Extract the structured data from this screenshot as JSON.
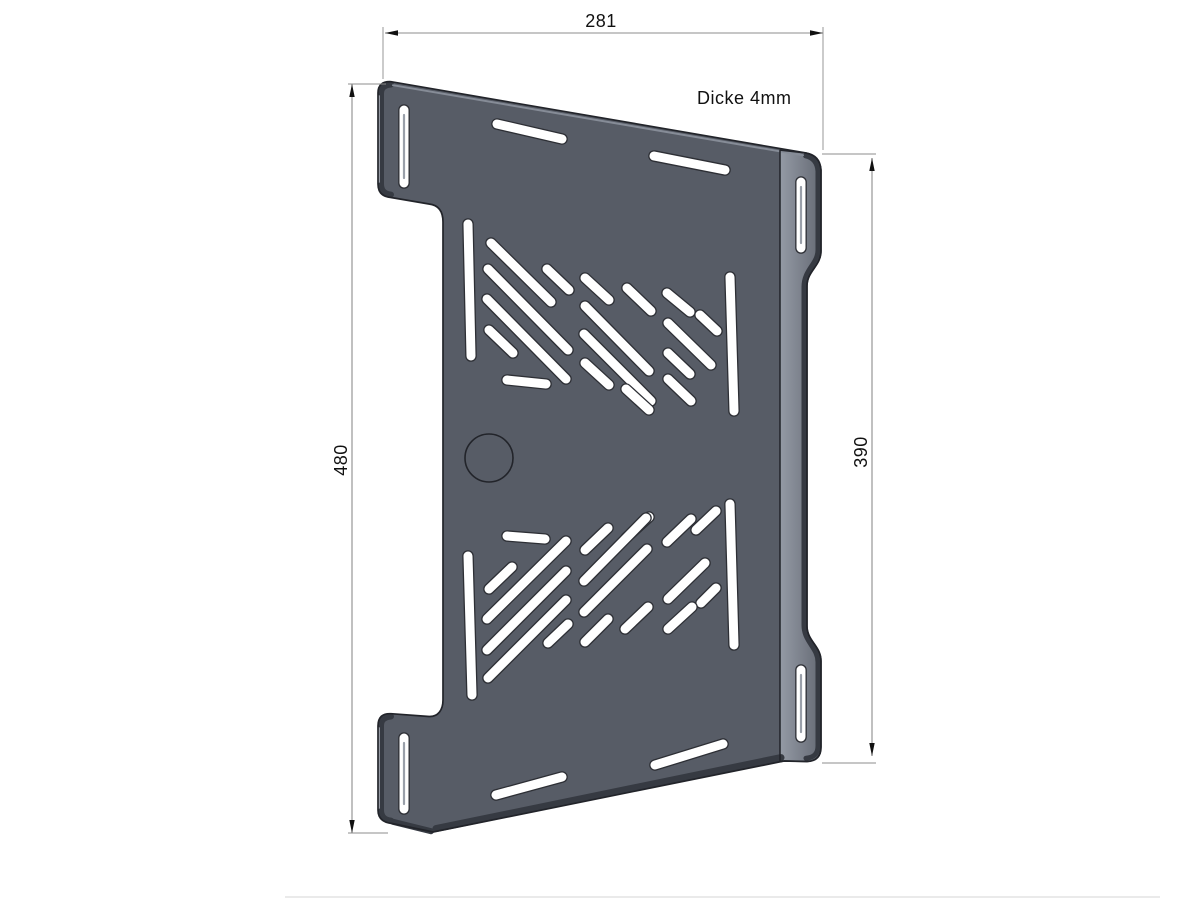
{
  "drawing": {
    "canvas": {
      "width": 1200,
      "height": 900,
      "background": "#ffffff"
    },
    "labels": {
      "top_width": "281",
      "left_height": "480",
      "right_height": "390",
      "thickness_note": "Dicke 4mm"
    },
    "colors": {
      "face": "#575c66",
      "face_light": "#949aa5",
      "face_shadow": "#656a74",
      "edge_dark": "#363a42",
      "edge_mid": "#868c97",
      "edge_light": "#b3b8c2",
      "outline": "#22242a",
      "slot_fill": "#ffffff",
      "slot_outline": "#2d2f35",
      "slot_inner": "#9aa0aa",
      "dim_line": "#8c8c8c",
      "text": "#111111",
      "rule": "#dddddd"
    },
    "paths": {
      "silhouette": "M 378 93 Q 378 81 391 81.7 L 806 153 Q 820 155.5 821 170 L 821 251 C 821 266 807 271 807 286 L 807 626 C 807 641 821 646 821 661 L 821 747 Q 821 761 807 761.5 L 784 761 L 433 832 L 392 823.5 Q 378 822 378 810 L 378 726 Q 378 713 391 713.7 L 429 716.5 C 438 717 443 710 443 700 L 443 222 C 443 211 438 205 429 204 L 391 197.5 Q 378 196.5 378 184 Z",
      "right_strip": "M 780 150.2 L 806 153 Q 820 155.5 821 170 L 821 251 C 821 266 807 271 807 286 L 807 626 C 807 641 821 646 821 661 L 821 747 Q 821 761 807 761.5 L 784 761 L 780 761.8 Z",
      "band_right": "M 805.5 155.8 Q 817 158.2 818 171 L 818 250 C 818 264 804 269.5 804 287 L 804 625 C 804 642 818 647.5 818 662 L 818 746 Q 818 757.5 806 758.2",
      "band_tab_top_left": "M 391 84.5 Q 381 85.4 381 93.5 L 381 184 Q 381 193.6 391 194.6",
      "sliver_tab_top_left": "M 378.9 96 L 378.9 182",
      "band_tab_bottom_left": "M 391 716.5 Q 381 717.4 381 725.5 L 381 810 Q 381 819.5 391 820.6",
      "sliver_tab_bottom_left": "M 378.9 728 L 378.9 808",
      "band_bottom_tab": "M 393 821.8 L 431 831.2",
      "band_bottom_main": "M 436 828.6 L 781 757.6",
      "top_highlight": "M 393 85.2 L 803 155.3"
    },
    "boundary_line": [
      780,
      150.5,
      780,
      761.5
    ],
    "circle": {
      "cx": 489,
      "cy": 458,
      "r": 24
    },
    "slots": {
      "width_default": 9,
      "items": [
        {
          "p": [
            404,
            110,
            404,
            183
          ],
          "tab": true
        },
        {
          "p": [
            404,
            738,
            404,
            809
          ],
          "tab": true
        },
        {
          "p": [
            801,
            182,
            801,
            248
          ],
          "tab": true
        },
        {
          "p": [
            801,
            670,
            801,
            737
          ],
          "tab": true
        },
        {
          "p": [
            497,
            124,
            562,
            139
          ]
        },
        {
          "p": [
            654,
            156,
            725,
            170
          ]
        },
        {
          "p": [
            496,
            795,
            562,
            777
          ]
        },
        {
          "p": [
            655,
            765,
            723,
            744
          ]
        },
        {
          "p": [
            468,
            224,
            471,
            356
          ]
        },
        {
          "p": [
            730,
            277,
            734,
            411
          ]
        },
        {
          "p": [
            491,
            243,
            551,
            302
          ]
        },
        {
          "p": [
            488,
            269,
            568,
            350
          ]
        },
        {
          "p": [
            487,
            299,
            566,
            379
          ]
        },
        {
          "p": [
            489,
            330,
            513,
            353
          ]
        },
        {
          "p": [
            507,
            380,
            546,
            384
          ]
        },
        {
          "p": [
            547,
            269,
            569,
            290
          ]
        },
        {
          "p": [
            585,
            278,
            609,
            300
          ]
        },
        {
          "p": [
            627,
            288,
            651,
            311
          ]
        },
        {
          "p": [
            585,
            306,
            649,
            371
          ]
        },
        {
          "p": [
            584,
            334,
            651,
            401
          ]
        },
        {
          "p": [
            585,
            363,
            609,
            385
          ]
        },
        {
          "p": [
            626,
            389,
            649,
            410
          ]
        },
        {
          "p": [
            667,
            293,
            690,
            312
          ]
        },
        {
          "p": [
            700,
            315,
            717,
            331
          ]
        },
        {
          "p": [
            668,
            323,
            711,
            365
          ]
        },
        {
          "p": [
            668,
            353,
            690,
            374
          ]
        },
        {
          "p": [
            668,
            379,
            691,
            401
          ]
        },
        {
          "p": [
            468,
            556,
            472,
            695
          ]
        },
        {
          "p": [
            730,
            504,
            734,
            645
          ]
        },
        {
          "p": [
            507,
            536,
            545,
            539
          ]
        },
        {
          "p": [
            489,
            589,
            512,
            567
          ]
        },
        {
          "p": [
            487,
            619,
            566,
            541
          ]
        },
        {
          "p": [
            487,
            650,
            566,
            571
          ]
        },
        {
          "p": [
            488,
            678,
            566,
            600
          ]
        },
        {
          "p": [
            548,
            643,
            568,
            624
          ]
        },
        {
          "p": [
            585,
            550,
            608,
            528
          ]
        },
        {
          "p": [
            626,
            538,
            649,
            517
          ]
        },
        {
          "p": [
            584,
            581,
            646,
            518
          ]
        },
        {
          "p": [
            584,
            612,
            647,
            549
          ]
        },
        {
          "p": [
            585,
            642,
            608,
            619
          ]
        },
        {
          "p": [
            625,
            629,
            648,
            607
          ]
        },
        {
          "p": [
            667,
            542,
            691,
            519
          ]
        },
        {
          "p": [
            696,
            530,
            716,
            511
          ]
        },
        {
          "p": [
            668,
            599,
            705,
            563
          ]
        },
        {
          "p": [
            701,
            603,
            716,
            588
          ]
        },
        {
          "p": [
            668,
            629,
            692,
            607
          ]
        }
      ]
    },
    "dimensions": [
      {
        "id": "top-width",
        "label": "281",
        "line": [
          385,
          33,
          823,
          33
        ],
        "arrows": [
          {
            "tip": [
              385,
              33
            ],
            "dir": "left"
          },
          {
            "tip": [
              823,
              33
            ],
            "dir": "right"
          }
        ],
        "extensions": [
          [
            383,
            27,
            383,
            79
          ],
          [
            823,
            27,
            823,
            150
          ]
        ]
      },
      {
        "id": "left-height",
        "label": "480",
        "line": [
          352,
          84,
          352,
          833
        ],
        "arrows": [
          {
            "tip": [
              352,
              84
            ],
            "dir": "up"
          },
          {
            "tip": [
              352,
              833
            ],
            "dir": "down"
          }
        ],
        "extensions": [
          [
            348,
            84,
            386,
            84
          ],
          [
            348,
            833,
            388,
            833
          ]
        ]
      },
      {
        "id": "right-height",
        "label": "390",
        "line": [
          872,
          158,
          872,
          756
        ],
        "arrows": [
          {
            "tip": [
              872,
              158
            ],
            "dir": "up"
          },
          {
            "tip": [
              872,
              756
            ],
            "dir": "down"
          }
        ],
        "extensions": [
          [
            822,
            154,
            876,
            154
          ],
          [
            822,
            763,
            876,
            763
          ]
        ]
      }
    ],
    "texts": [
      {
        "content": "281",
        "x": 601,
        "y": 27,
        "anchor": "middle",
        "transform": "rotate(0 601 27)"
      },
      {
        "content": "480",
        "x": 341,
        "y": 466,
        "anchor": "middle",
        "transform": "rotate(-90 341 460)"
      },
      {
        "content": "390",
        "x": 861,
        "y": 458,
        "anchor": "middle",
        "transform": "rotate(-90 861 452)"
      },
      {
        "content": "Dicke 4mm",
        "x": 697,
        "y": 104,
        "anchor": "start",
        "transform": "rotate(0 697 104)"
      }
    ],
    "page_rule": [
      285,
      897,
      1160,
      897
    ]
  }
}
